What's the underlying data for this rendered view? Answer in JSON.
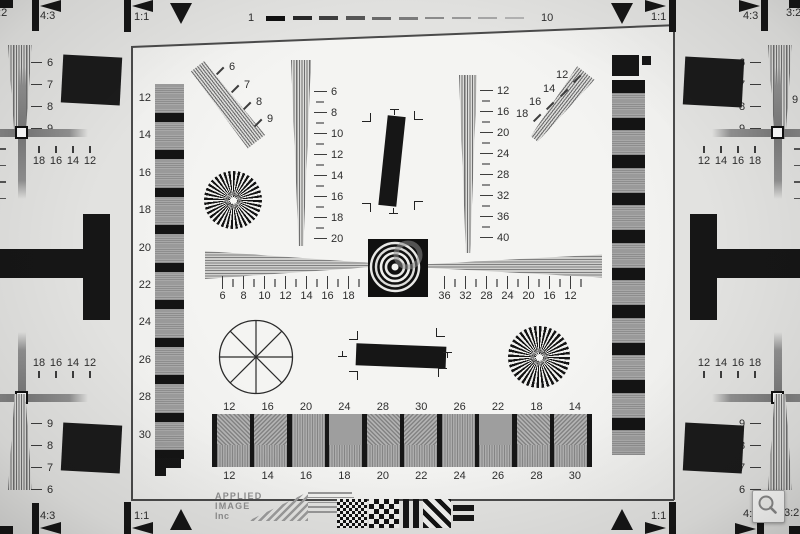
{
  "colors": {
    "bg": "#e2e2e0",
    "chart_bg": "#f3f3f1",
    "ink": "#161616",
    "wedge_gray": "#8c8c8c",
    "label_text": "#2e2e2e",
    "logo_gray": "#8e8e8e"
  },
  "top_edge": {
    "left_labels": {
      "ratio_32": "3:2",
      "ratio_43": "4:3",
      "ratio_11": "1:1"
    },
    "right_labels": {
      "ratio_11": "1:1",
      "ratio_43": "4:3",
      "ratio_32": "3:2"
    },
    "ruler": {
      "start_label": "1",
      "end_label": "10",
      "dash_count": 10,
      "dash_heights": [
        5,
        4.5,
        4,
        3.5,
        3,
        3,
        2.5,
        2,
        2,
        1.5
      ],
      "dash_colors": [
        "#101010",
        "#272727",
        "#3e3e3e",
        "#555555",
        "#696969",
        "#7b7b7b",
        "#8a8a8a",
        "#989898",
        "#a6a6a6",
        "#b2b2b2"
      ]
    }
  },
  "bottom_edge": {
    "left_labels": {
      "ratio_43": "4:3",
      "ratio_11": "1:1"
    },
    "right_labels": {
      "ratio_11": "1:1",
      "ratio_43": "4:3",
      "ratio_32": "3:2"
    }
  },
  "chart": {
    "left_step_labels": [
      "12",
      "14",
      "16",
      "18",
      "20",
      "22",
      "24",
      "26",
      "28",
      "30"
    ],
    "wedge_upper_left_labels": [
      "6",
      "7",
      "8",
      "9"
    ],
    "center_left_vscale_labels": [
      "6",
      "8",
      "10",
      "12",
      "14",
      "16",
      "18",
      "20"
    ],
    "center_right_vscale_labels": [
      "12",
      "16",
      "20",
      "24",
      "28",
      "32",
      "36",
      "40"
    ],
    "wedge_upper_right_labels": [
      "12",
      "14",
      "16",
      "18"
    ],
    "hscale_left_labels": [
      "6",
      "8",
      "10",
      "12",
      "14",
      "16",
      "18"
    ],
    "hscale_right_labels": [
      "36",
      "32",
      "28",
      "24",
      "20",
      "16",
      "12"
    ],
    "blocks_top_labels": [
      "12",
      "16",
      "20",
      "24",
      "28",
      "30",
      "26",
      "22",
      "18",
      "14"
    ],
    "blocks_bottom_labels": [
      "12",
      "14",
      "16",
      "18",
      "20",
      "22",
      "24",
      "26",
      "28",
      "30"
    ]
  },
  "edges": {
    "left_top_labels": [
      "6",
      "7",
      "8",
      "9"
    ],
    "left_scale_top": [
      "18",
      "16",
      "14",
      "12"
    ],
    "left_scale_bottom": [
      "18",
      "16",
      "14",
      "12"
    ],
    "left_bottom_labels": [
      "9",
      "8",
      "7",
      "6"
    ],
    "right_top_labels": [
      "6",
      "7",
      "8",
      "9"
    ],
    "right_scale_top": [
      "12",
      "14",
      "16",
      "18"
    ],
    "right_scale_bottom": [
      "12",
      "14",
      "16",
      "18"
    ],
    "right_bottom_labels": [
      "9",
      "8",
      "7",
      "6"
    ],
    "clipped_left_digit": "9",
    "clipped_right_digit": "9",
    "edge_tick_count": 4
  },
  "logo": {
    "line1": "APPLIED",
    "line2": "IMAGE",
    "line3": "Inc",
    "address_line_count": 5
  },
  "controls": {
    "zoom_button_icon": "magnifier"
  }
}
